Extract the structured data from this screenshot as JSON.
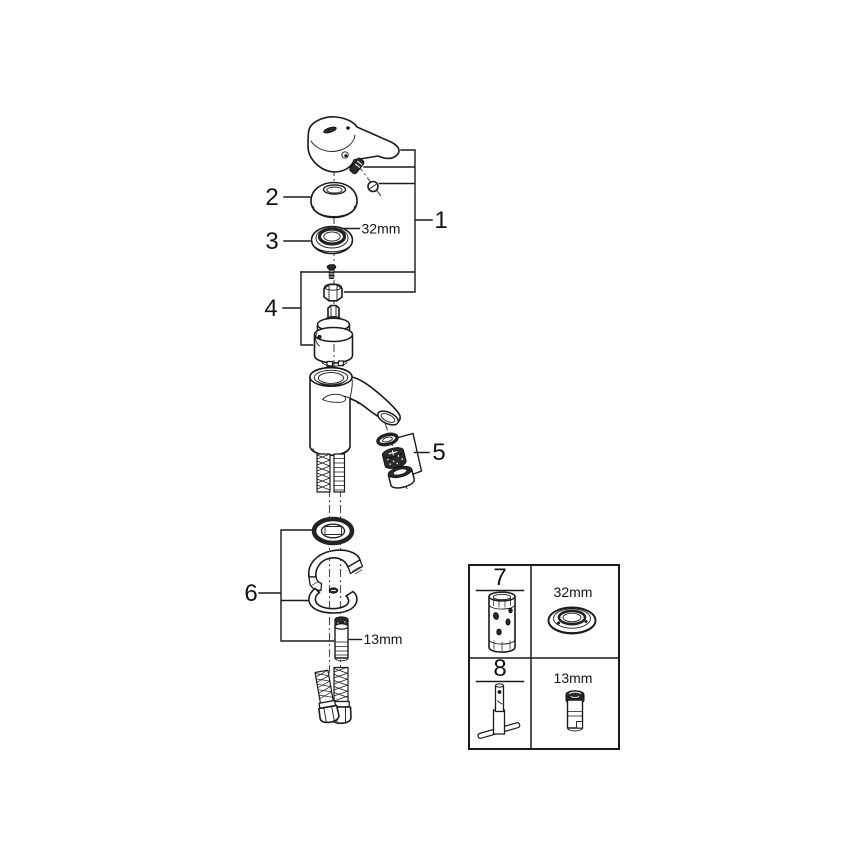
{
  "diagram": {
    "kind": "exploded-parts-diagram",
    "subject": "single-lever basin mixer faucet",
    "colors": {
      "background": "#ffffff",
      "line": "#1b1b1b",
      "dark_fill": "#2b2b2b"
    },
    "callouts": {
      "item1": "1",
      "item2": "2",
      "item3": "3",
      "item4": "4",
      "item5": "5",
      "item6": "6"
    },
    "dimensions": {
      "escutcheon_ring": "32mm",
      "mounting_stud": "13mm"
    },
    "parts": [
      "lever-handle",
      "grub-screw",
      "screw-cover-cap",
      "dome-cap",
      "escutcheon-ring",
      "fixing-screw",
      "cartridge-nut",
      "ceramic-cartridge",
      "faucet-body-with-spout",
      "aerator-washer",
      "aerator-insert",
      "aerator-housing",
      "base-gasket",
      "mounting-wedge",
      "horseshoe-washer",
      "mounting-stud",
      "flexible-supply-hoses"
    ],
    "inset": {
      "cells": [
        {
          "label": "7",
          "depicts": "mounting-sleeve-tool"
        },
        {
          "label": "32mm",
          "depicts": "escutcheon-ring-spare"
        },
        {
          "label": "8",
          "depicts": "socket-wrench-tool"
        },
        {
          "label": "13mm",
          "depicts": "mounting-stud-spare"
        }
      ]
    }
  }
}
